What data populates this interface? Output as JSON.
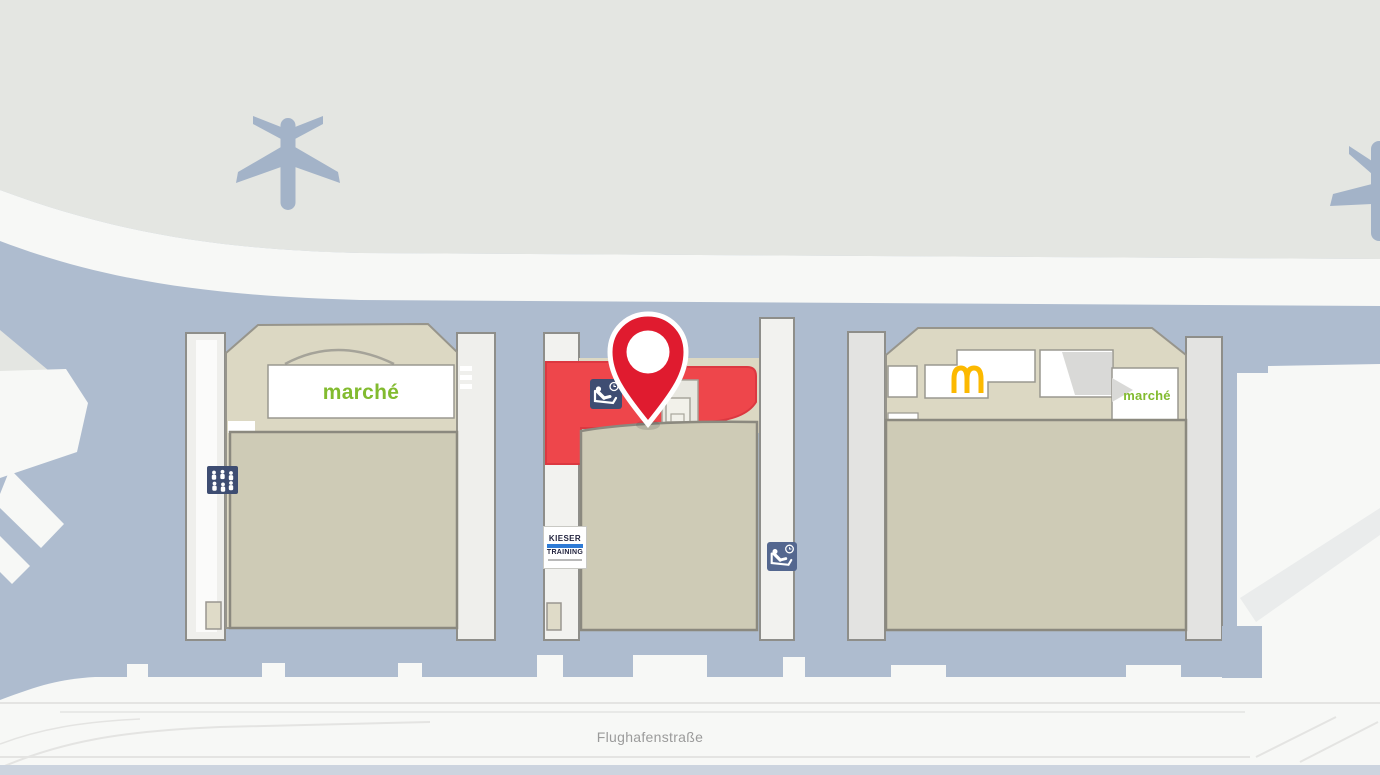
{
  "map": {
    "street": {
      "label": "Flughafenstraße"
    },
    "labels": {
      "marche_left": "marché",
      "marche_right": "marché",
      "kieser_line1": "KIESER",
      "kieser_line2": "TRAINING"
    },
    "icons": {
      "pin": "location-pin",
      "mcdonalds": "mcdonalds-golden-arches",
      "massage_chair": "massage-chair-with-clock",
      "people_group": "people-group-seating",
      "airplane": "airplane-silhouette"
    },
    "colors": {
      "selected_area": "#ee464b",
      "pin": "#e01b2f",
      "marche_green": "#82bb2f",
      "mcdonalds_yellow": "#fcb900",
      "icon_navy": "#3e4d72",
      "icon_blue_light": "#54678f",
      "road_blue": "#aebccf",
      "apron_gray": "#e4e6e2",
      "building_beige": "#dcd8c3",
      "hall_beige": "#cecbb6"
    }
  }
}
